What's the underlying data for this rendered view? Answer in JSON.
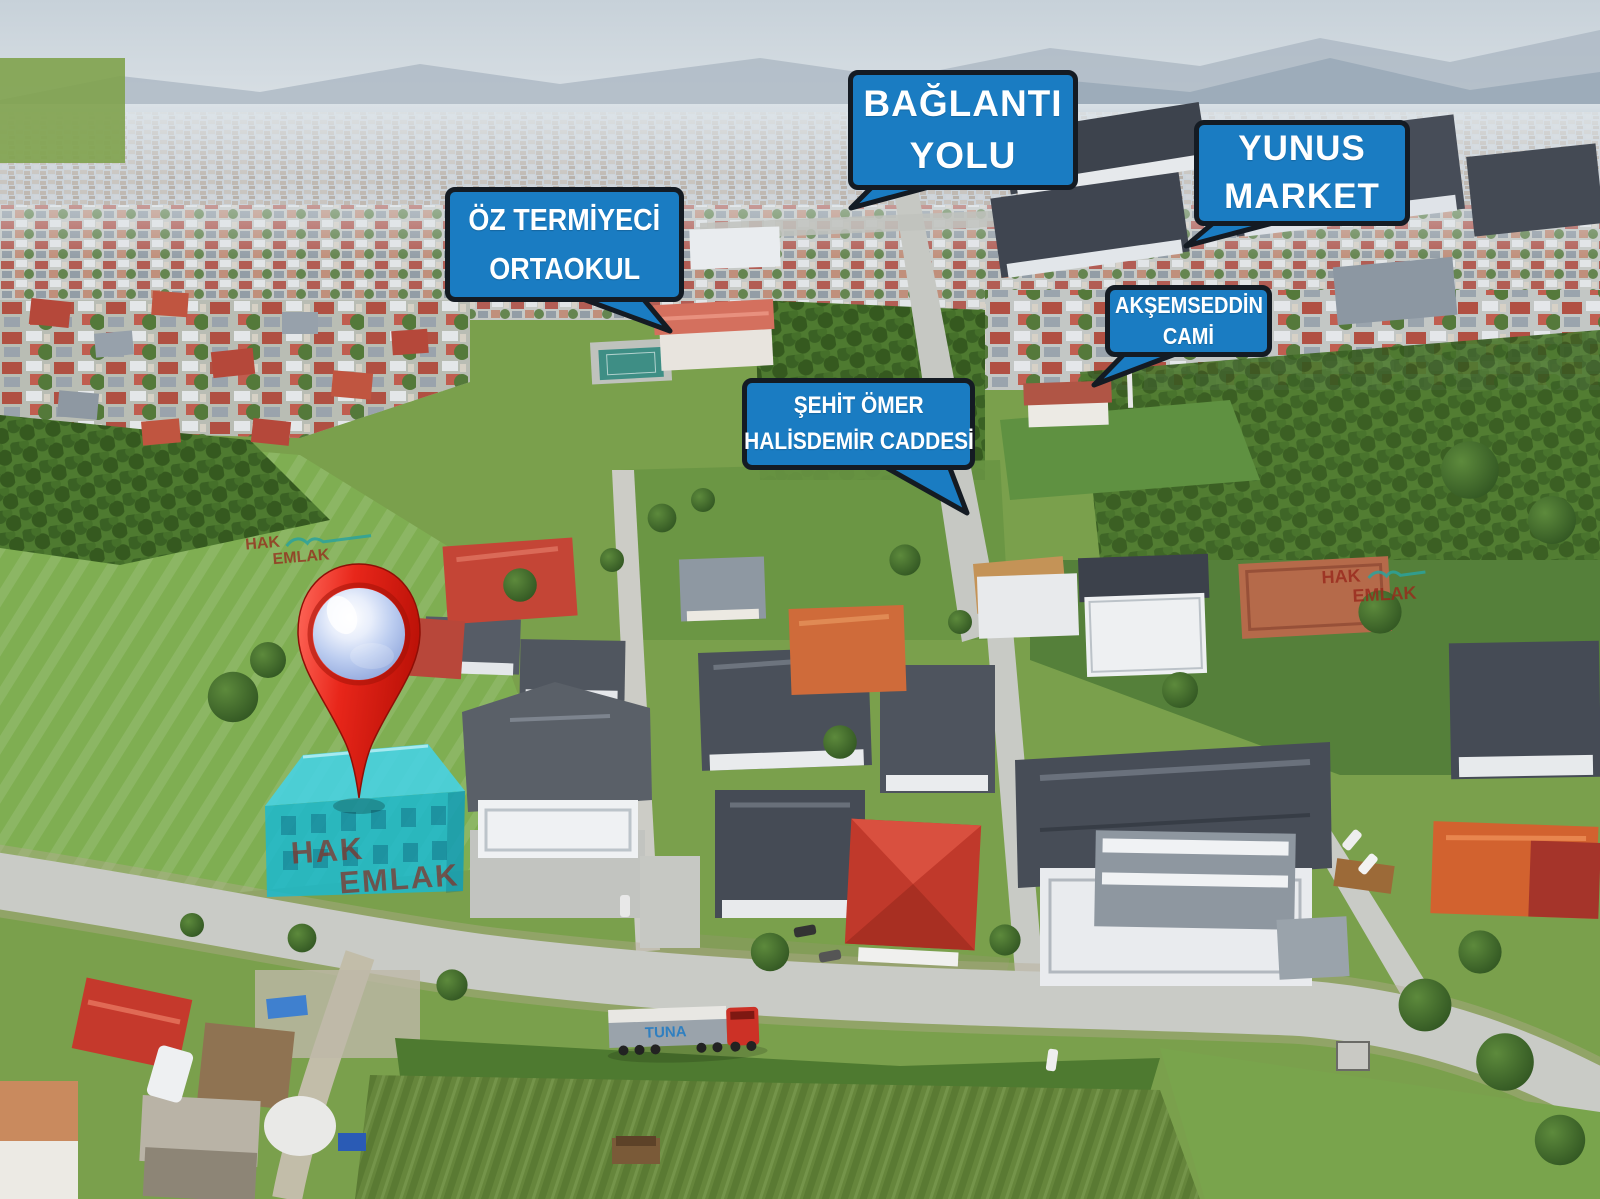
{
  "callouts": [
    {
      "name": "baglanti-yolu",
      "lines": [
        "BAĞLANTI",
        "YOLU"
      ],
      "tail_direction": "down-left"
    },
    {
      "name": "yunus-market",
      "lines": [
        "YUNUS",
        "MARKET"
      ],
      "tail_direction": "down-left"
    },
    {
      "name": "oz-termiyeci-ortaokul",
      "lines": [
        "ÖZ TERMİYECİ",
        "ORTAOKUL"
      ],
      "tail_direction": "down-right"
    },
    {
      "name": "aksemseddin-cami",
      "lines": [
        "AKŞEMSEDDİN",
        "CAMİ"
      ],
      "tail_direction": "down-left"
    },
    {
      "name": "sehit-omer-halisdemir-caddesi",
      "lines": [
        "ŞEHİT ÖMER",
        "HALİSDEMİR CADDESİ"
      ],
      "tail_direction": "down-right"
    }
  ],
  "watermark": {
    "line1": "HAK",
    "line2": "EMLAK"
  },
  "truck": {
    "label": "TUNA"
  },
  "marker_pin": {
    "color": "#e8261a",
    "sphere_color": "#b9c9ec"
  },
  "highlighted_building": {
    "roof_color": "#45d3e6",
    "wall_color": "#17b9d4"
  },
  "colors": {
    "callout_fill": "#1a7cc2",
    "callout_border": "#141b23",
    "callout_text": "#ffffff",
    "pin_red": "#e8261a",
    "highlight_cyan": "#1fc6de",
    "watermark_red": "#9c352a",
    "watermark_teal": "#2ba29c",
    "truck_cab_red": "#cc3126",
    "truck_logo_blue": "#2f7fc0"
  }
}
